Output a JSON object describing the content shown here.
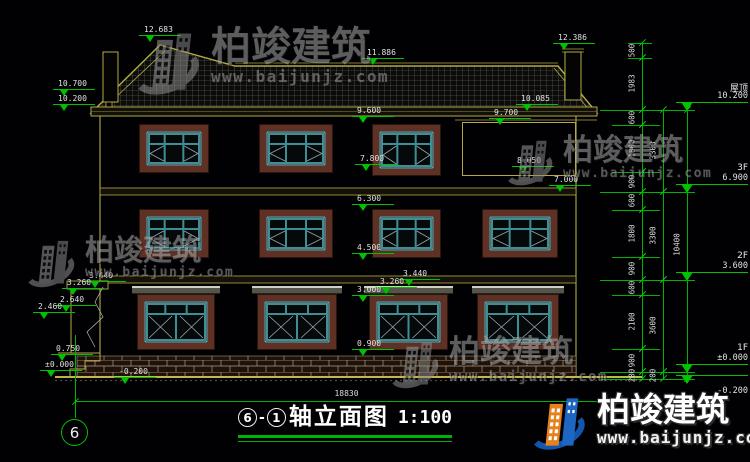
{
  "watermark": {
    "brand": "柏竣建筑",
    "url": "www.baijunjz.com"
  },
  "logo": {
    "brand": "柏竣建筑",
    "url": "www.baijunjz.com"
  },
  "title": {
    "axis_from": "6",
    "separator": "-",
    "axis_to": "1",
    "text": "轴立面图",
    "scale": "1:100"
  },
  "axis_bubble": "6",
  "bottom_dim": {
    "value": "18830"
  },
  "levels_right": [
    {
      "label": "屋顶",
      "value": "10.200",
      "y": 110
    },
    {
      "label": "3F",
      "value": "6.900",
      "y": 192
    },
    {
      "label": "2F",
      "value": "3.600",
      "y": 280
    },
    {
      "label": "1F",
      "value": "±0.000",
      "y": 372
    },
    {
      "label": "",
      "value": "-0.200",
      "y": 383,
      "below": true
    }
  ],
  "markers": [
    {
      "t": "12.683",
      "x": 139,
      "y": 26
    },
    {
      "t": "11.886",
      "x": 362,
      "y": 49
    },
    {
      "t": "12.386",
      "x": 553,
      "y": 34
    },
    {
      "t": "10.700",
      "x": 53,
      "y": 80
    },
    {
      "t": "10.200",
      "x": 53,
      "y": 95
    },
    {
      "t": "9.600",
      "x": 352,
      "y": 107
    },
    {
      "t": "10.085",
      "x": 516,
      "y": 95
    },
    {
      "t": "9.700",
      "x": 489,
      "y": 109
    },
    {
      "t": "8.050",
      "x": 512,
      "y": 157
    },
    {
      "t": "7.000",
      "x": 549,
      "y": 176
    },
    {
      "t": "7.800",
      "x": 355,
      "y": 155
    },
    {
      "t": "6.300",
      "x": 352,
      "y": 195
    },
    {
      "t": "4.500",
      "x": 352,
      "y": 244
    },
    {
      "t": "3.440",
      "x": 398,
      "y": 270
    },
    {
      "t": "3.260",
      "x": 375,
      "y": 278
    },
    {
      "t": "3.000",
      "x": 352,
      "y": 286
    },
    {
      "t": "0.900",
      "x": 352,
      "y": 340
    },
    {
      "t": "3.440",
      "x": 84,
      "y": 272
    },
    {
      "t": "3.260",
      "x": 62,
      "y": 279
    },
    {
      "t": "2.640",
      "x": 55,
      "y": 296
    },
    {
      "t": "2.460",
      "x": 33,
      "y": 303
    },
    {
      "t": "0.750",
      "x": 51,
      "y": 345
    },
    {
      "t": "±0.000",
      "x": 40,
      "y": 361
    },
    {
      "t": "-0.200",
      "x": 114,
      "y": 368
    }
  ],
  "vdims": [
    {
      "t": "500",
      "x": 642,
      "y1": 43,
      "y2": 58
    },
    {
      "t": "1983",
      "x": 642,
      "y1": 58,
      "y2": 110
    },
    {
      "t": "600",
      "x": 642,
      "y1": 110,
      "y2": 125
    },
    {
      "t": "1800",
      "x": 642,
      "y1": 125,
      "y2": 172
    },
    {
      "t": "900",
      "x": 642,
      "y1": 172,
      "y2": 192
    },
    {
      "t": "600",
      "x": 642,
      "y1": 192,
      "y2": 210
    },
    {
      "t": "1800",
      "x": 642,
      "y1": 210,
      "y2": 257
    },
    {
      "t": "900",
      "x": 642,
      "y1": 257,
      "y2": 280
    },
    {
      "t": "600",
      "x": 642,
      "y1": 280,
      "y2": 295
    },
    {
      "t": "2100",
      "x": 642,
      "y1": 295,
      "y2": 349
    },
    {
      "t": "900",
      "x": 642,
      "y1": 349,
      "y2": 372
    },
    {
      "t": "200",
      "x": 642,
      "y1": 372,
      "y2": 379
    },
    {
      "t": "3300",
      "x": 663,
      "y1": 110,
      "y2": 192
    },
    {
      "t": "3300",
      "x": 663,
      "y1": 192,
      "y2": 280
    },
    {
      "t": "3600",
      "x": 663,
      "y1": 280,
      "y2": 372
    },
    {
      "t": "200",
      "x": 663,
      "y1": 372,
      "y2": 379
    },
    {
      "t": "10400",
      "x": 687,
      "y1": 110,
      "y2": 379
    }
  ],
  "hdim": {
    "x1": 75,
    "x2": 618,
    "y": 401
  },
  "extensions": [
    {
      "x1": 628,
      "x2": 652,
      "y": 43
    },
    {
      "x1": 628,
      "x2": 652,
      "y": 58
    },
    {
      "x1": 600,
      "x2": 695,
      "y": 110
    },
    {
      "x1": 612,
      "x2": 660,
      "y": 125
    },
    {
      "x1": 612,
      "x2": 660,
      "y": 172
    },
    {
      "x1": 600,
      "x2": 695,
      "y": 192
    },
    {
      "x1": 612,
      "x2": 660,
      "y": 210
    },
    {
      "x1": 612,
      "x2": 660,
      "y": 257
    },
    {
      "x1": 600,
      "x2": 695,
      "y": 280
    },
    {
      "x1": 612,
      "x2": 660,
      "y": 295
    },
    {
      "x1": 612,
      "x2": 660,
      "y": 349
    },
    {
      "x1": 600,
      "x2": 695,
      "y": 372
    },
    {
      "x1": 600,
      "x2": 695,
      "y": 379
    }
  ],
  "grid_line": {
    "x": 75,
    "y1": 335,
    "y2": 418
  },
  "windows": [
    {
      "x": 140,
      "y": 125,
      "w": 68,
      "h": 47,
      "type": "c3",
      "cornice": false
    },
    {
      "x": 260,
      "y": 125,
      "w": 72,
      "h": 47,
      "type": "c3",
      "cornice": false
    },
    {
      "x": 373,
      "y": 125,
      "w": 67,
      "h": 50,
      "type": "c3",
      "cornice": false
    },
    {
      "x": 140,
      "y": 210,
      "w": 68,
      "h": 47,
      "type": "c3",
      "cornice": false
    },
    {
      "x": 260,
      "y": 210,
      "w": 72,
      "h": 47,
      "type": "c3",
      "cornice": false
    },
    {
      "x": 373,
      "y": 210,
      "w": 67,
      "h": 47,
      "type": "c3",
      "cornice": false
    },
    {
      "x": 483,
      "y": 210,
      "w": 74,
      "h": 47,
      "type": "c3",
      "cornice": false
    },
    {
      "x": 138,
      "y": 295,
      "w": 76,
      "h": 54,
      "type": "x2",
      "cornice": true
    },
    {
      "x": 258,
      "y": 295,
      "w": 78,
      "h": 54,
      "type": "x2",
      "cornice": true
    },
    {
      "x": 370,
      "y": 295,
      "w": 77,
      "h": 54,
      "type": "x2",
      "cornice": true
    },
    {
      "x": 478,
      "y": 295,
      "w": 80,
      "h": 54,
      "type": "x2",
      "cornice": true
    }
  ],
  "panel": {
    "x": 462,
    "y": 122,
    "w": 114,
    "h": 54
  },
  "watermark_marks": [
    {
      "x": 130,
      "y": 27,
      "icon": 74,
      "brand": 40,
      "url": 16
    },
    {
      "x": 502,
      "y": 136,
      "icon": 54,
      "brand": 30,
      "url": 13
    },
    {
      "x": 22,
      "y": 236,
      "icon": 56,
      "brand": 29,
      "url": 13
    },
    {
      "x": 386,
      "y": 337,
      "icon": 56,
      "brand": 31,
      "url": 14
    }
  ],
  "logo_pos": {
    "x": 527,
    "y": 393,
    "icon": 62,
    "brand": 33,
    "url": 16
  }
}
